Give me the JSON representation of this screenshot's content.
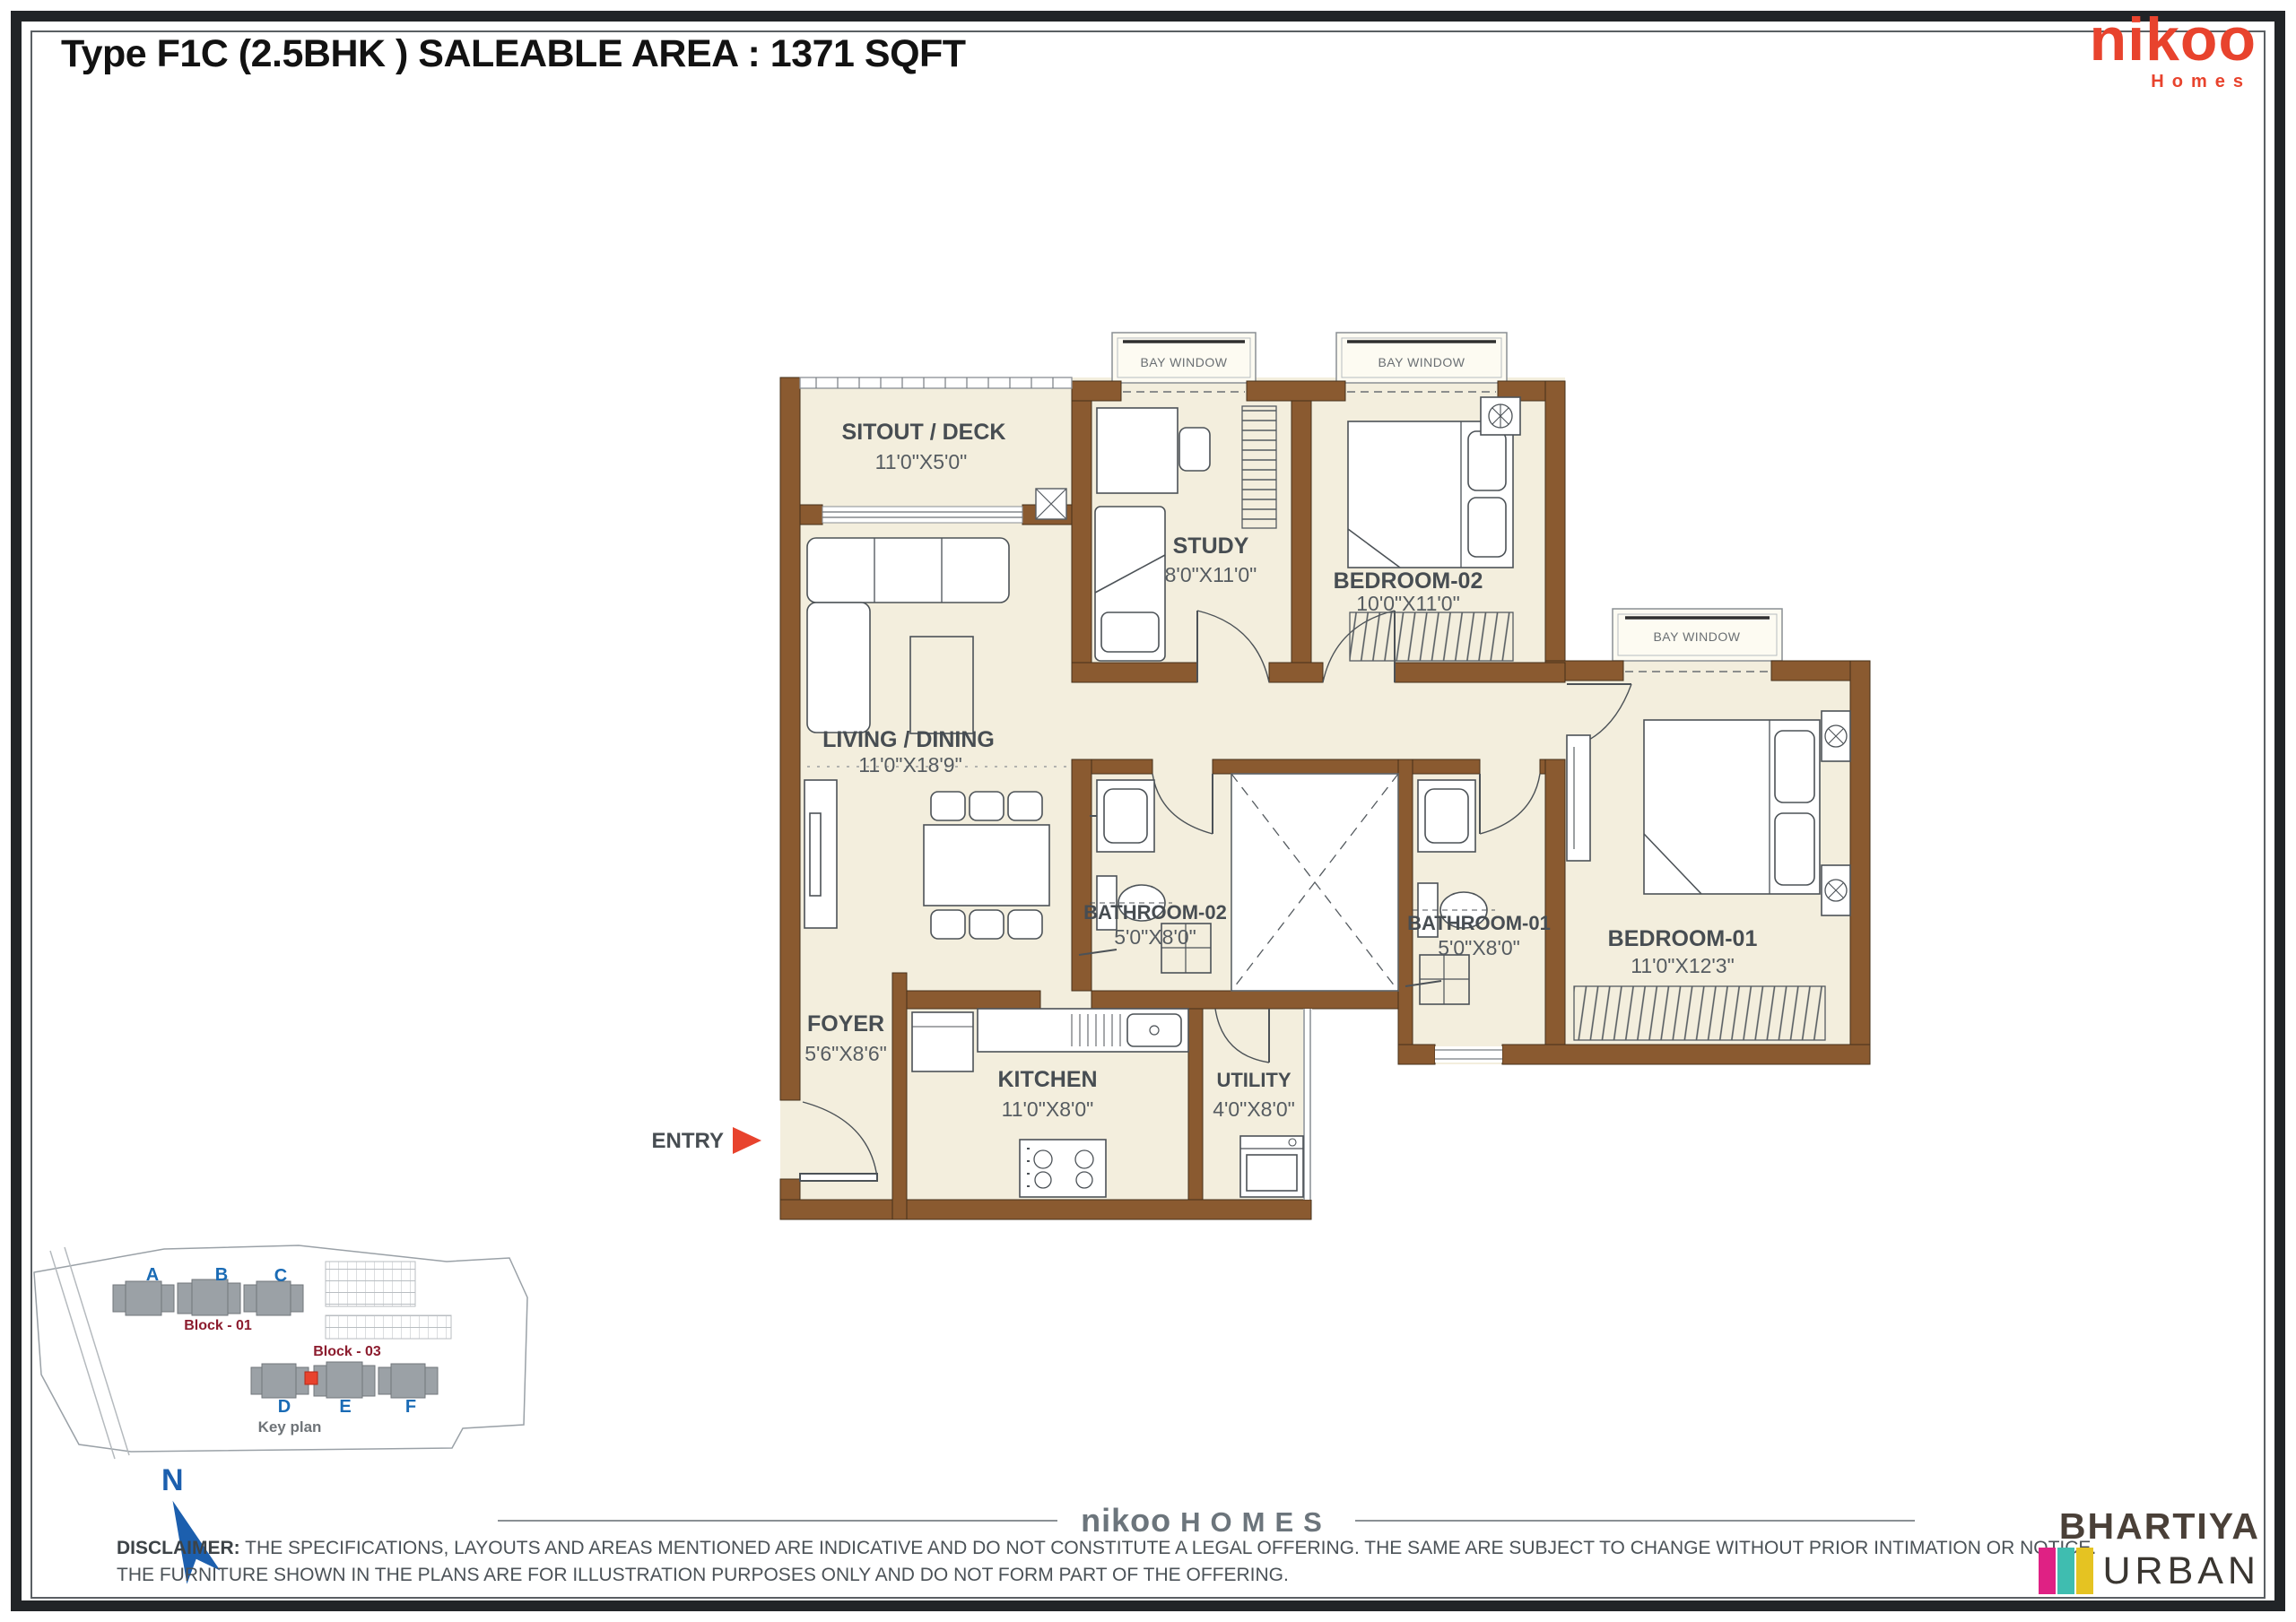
{
  "header": {
    "title": "Type F1C (2.5BHK ) SALEABLE AREA : 1371 SQFT"
  },
  "brand": {
    "name": "nikoo",
    "tagline": "Homes"
  },
  "plan": {
    "bay_window_label": "BAY WINDOW",
    "entry_label": "ENTRY",
    "rooms": [
      {
        "name": "SITOUT / DECK",
        "dims": "11'0\"X5'0\""
      },
      {
        "name": "STUDY",
        "dims": "8'0\"X11'0\""
      },
      {
        "name": "BEDROOM-02",
        "dims": "10'0\"X11'0\""
      },
      {
        "name": "LIVING / DINING",
        "dims": "11'0\"X18'9\""
      },
      {
        "name": "BATHROOM-02",
        "dims": "5'0\"X8'0\""
      },
      {
        "name": "BATHROOM-01",
        "dims": "5'0\"X8'0\""
      },
      {
        "name": "BEDROOM-01",
        "dims": "11'0\"X12'3\""
      },
      {
        "name": "FOYER",
        "dims": "5'6\"X8'6\""
      },
      {
        "name": "KITCHEN",
        "dims": "11'0\"X8'0\""
      },
      {
        "name": "UTILITY",
        "dims": "4'0\"X8'0\""
      }
    ]
  },
  "key_plan": {
    "caption": "Key plan",
    "towers": [
      "A",
      "B",
      "C",
      "D",
      "E",
      "F"
    ],
    "blocks": [
      "Block - 01",
      "Block - 03"
    ]
  },
  "compass": {
    "north_label": "N"
  },
  "footer": {
    "center_brand": {
      "nikoo": "nikoo",
      "homes": "HOMES"
    },
    "disclaimer_label": "DISCLAIMER:",
    "disclaimer_line1": "THE SPECIFICATIONS, LAYOUTS AND AREAS MENTIONED ARE INDICATIVE AND DO NOT CONSTITUTE A LEGAL OFFERING. THE SAME ARE SUBJECT TO CHANGE WITHOUT PRIOR INTIMATION OR NOTICE.",
    "disclaimer_line2": "THE FURNITURE SHOWN IN THE PLANS ARE FOR ILLUSTRATION PURPOSES ONLY AND DO NOT FORM PART OF THE OFFERING.",
    "logo": {
      "line1": "BHARTIYA",
      "line2": "URBAN"
    }
  },
  "colors": {
    "accent_red": "#e8432d",
    "wall_brown": "#8a5a30",
    "floor_cream": "#f3eedd",
    "key_blue": "#1a6bb5",
    "block_maroon": "#8c1c2e",
    "bar_pink": "#df2184",
    "bar_teal": "#3fbdb0",
    "bar_yellow": "#e5c322"
  }
}
